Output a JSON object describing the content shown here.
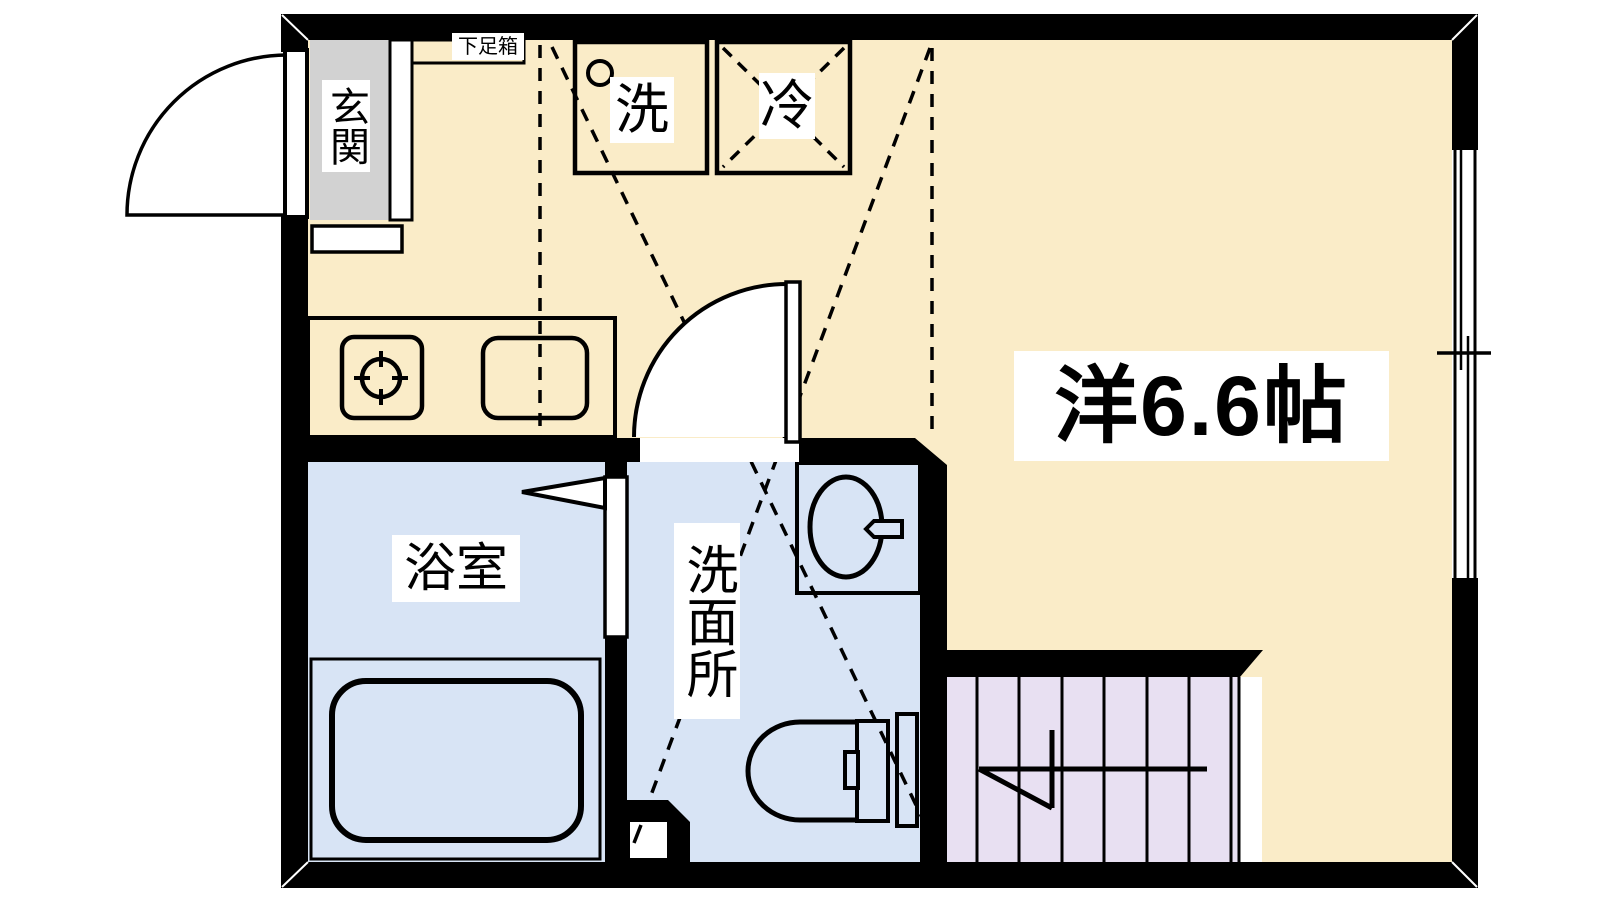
{
  "title": "Apartment floor plan",
  "labels": {
    "entrance": "玄関",
    "shoe_box": "下足箱",
    "washer": "洗",
    "refrigerator": "冷",
    "western_room": "洋6.6帖",
    "bathroom": "浴室",
    "washroom": "洗面所"
  },
  "colors": {
    "floor_main": "#faecc8",
    "floor_wet": "#d8e4f5",
    "floor_stairs": "#e8e0f2",
    "entrance_gray": "#d2d2d2",
    "wall": "#000000",
    "label_bg": "#ffffff"
  }
}
